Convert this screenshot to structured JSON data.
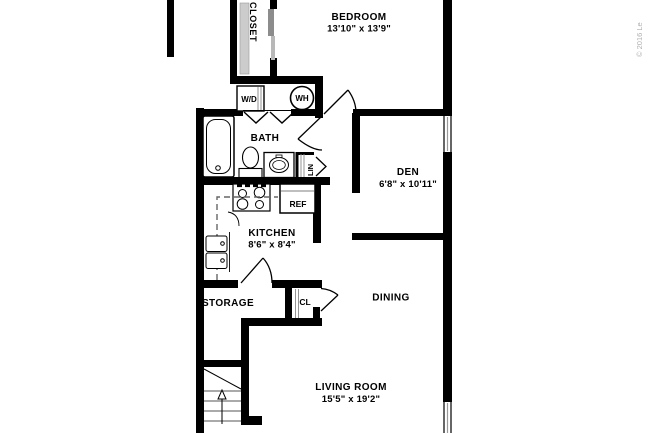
{
  "plan": {
    "bedroom": {
      "name": "BEDROOM",
      "dims": "13'10\" x 13'9\""
    },
    "closet": {
      "name": "CLOSET"
    },
    "washer_dryer": {
      "label": "W/D"
    },
    "water_heater": {
      "label": "WH"
    },
    "bath": {
      "name": "BATH"
    },
    "linen": {
      "label": "LIN"
    },
    "den": {
      "name": "DEN",
      "dims": "6'8\" x 10'11\""
    },
    "refrigerator": {
      "label": "REF"
    },
    "kitchen": {
      "name": "KITCHEN",
      "dims": "8'6\" x 8'4\""
    },
    "storage": {
      "name": "STORAGE"
    },
    "hall_closet": {
      "label": "CL"
    },
    "dining": {
      "name": "DINING"
    },
    "living_room": {
      "name": "LIVING ROOM",
      "dims": "15'5\" x 19'2\""
    }
  },
  "watermark": {
    "text": "© 2016 Le"
  },
  "colors": {
    "wall": "#000000",
    "background": "#ffffff",
    "fixture_line": "#000000",
    "shelf_gray": "#cccccc",
    "door_gray": "#8c8c8c",
    "watermark_gray": "#b0b0b0"
  }
}
